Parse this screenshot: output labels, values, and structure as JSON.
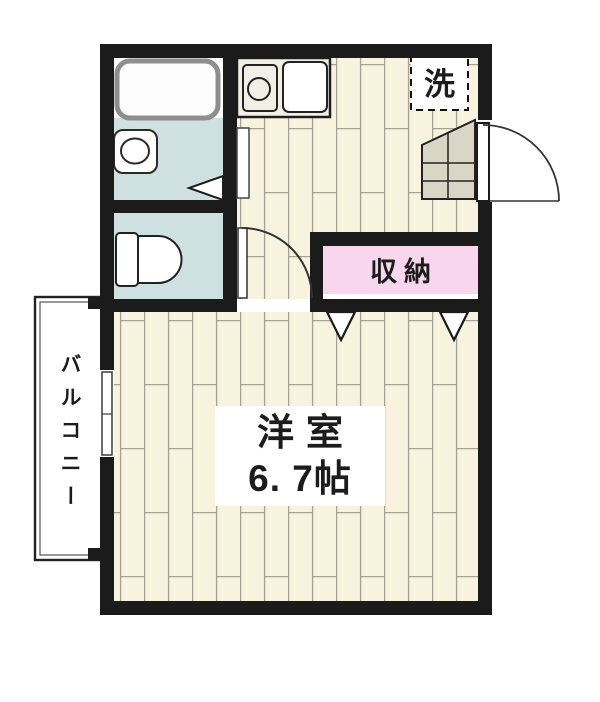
{
  "floorplan": {
    "labels": {
      "washer": "洗",
      "closet": "収納",
      "main_room_name": "洋室",
      "main_room_size": "6. 7帖",
      "balcony": "バルコニー"
    },
    "colors": {
      "wall": "#1b1b1b",
      "floor_base": "#f7f3df",
      "floor_line": "#a5a193",
      "wet_area": "#cfe0e1",
      "closet_pink": "#f8d7ee",
      "cabinet_gray": "#d9d6c6",
      "fixture_white": "#ffffff",
      "tub_outline": "#8e8e8e",
      "background": "#ffffff"
    }
  }
}
